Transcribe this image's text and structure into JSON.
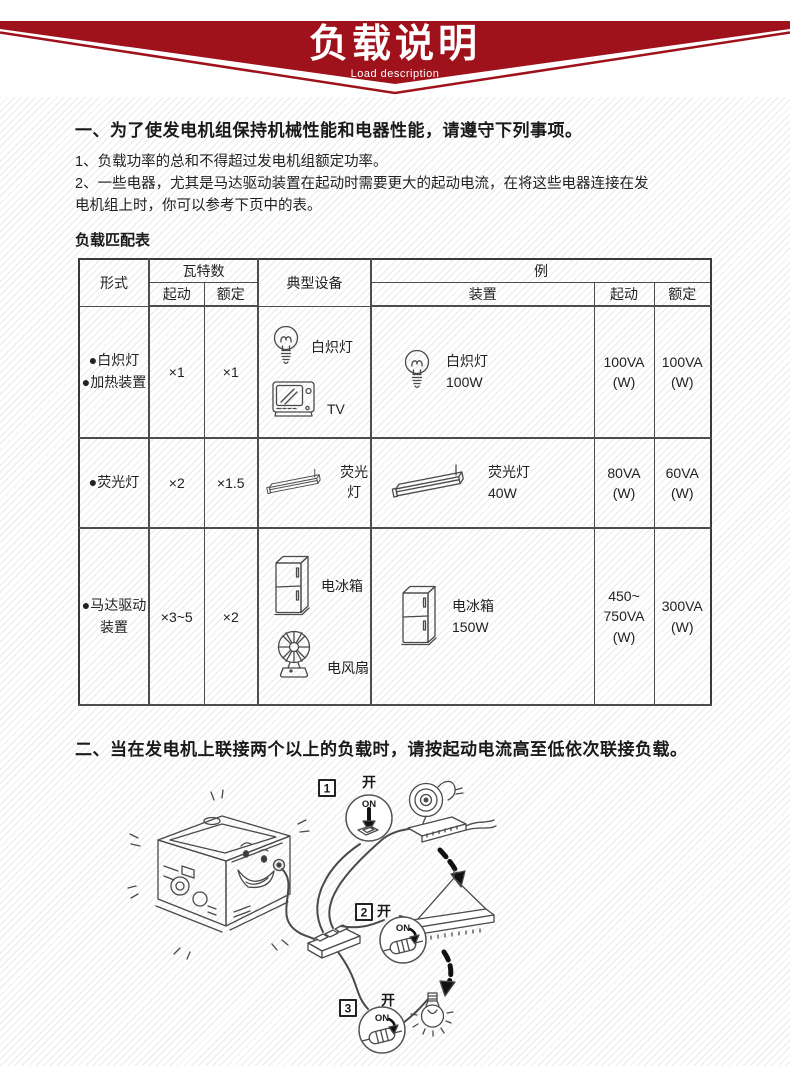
{
  "banner": {
    "title": "负载说明",
    "subtitle": "Load description"
  },
  "colors": {
    "banner_red": "#9f121b"
  },
  "section1": {
    "heading": "一、为了使发电机组保持机械性能和电器性能，请遵守下列事项。",
    "item1": "1、负载功率的总和不得超过发电机组额定功率。",
    "item2": "2、一些电器，尤其是马达驱动装置在起动时需要更大的起动电流，在将这些电器连接在发\n电机组上时，你可以参考下页中的表。"
  },
  "table": {
    "caption": "负载匹配表",
    "header": {
      "type": "形式",
      "watts": "瓦特数",
      "start": "起动",
      "rated": "额定",
      "typical": "典型设备",
      "example": "例",
      "device": "装置",
      "ex_start": "起动",
      "ex_rated": "额定"
    },
    "rows": [
      {
        "type": "●白炽灯\n●加热装置",
        "start_factor": "×1",
        "rated_factor": "×1",
        "typical1_label": "白炽灯",
        "typical2_label": "TV",
        "device_label": "白炽灯\n100W",
        "ex_start": "100VA\n(W)",
        "ex_rated": "100VA\n(W)"
      },
      {
        "type": "●荧光灯",
        "start_factor": "×2",
        "rated_factor": "×1.5",
        "typical1_label": "荧光灯",
        "device_label": "荧光灯\n40W",
        "ex_start": "80VA\n(W)",
        "ex_rated": "60VA\n(W)"
      },
      {
        "type": "●马达驱动\n装置",
        "start_factor": "×3~5",
        "rated_factor": "×2",
        "typical1_label": "电冰箱",
        "typical2_label": "电风扇",
        "device_label": "电冰箱\n150W",
        "ex_start": "450~\n750VA\n(W)",
        "ex_rated": "300VA\n(W)"
      }
    ]
  },
  "section2": {
    "heading": "二、当在发电机上联接两个以上的负载时，请按起动电流高至低依次联接负载。"
  },
  "illustration": {
    "steps": [
      {
        "num": "1",
        "power": "开",
        "switch": "ON"
      },
      {
        "num": "2",
        "power": "开",
        "switch": "ON"
      },
      {
        "num": "3",
        "power": "开",
        "switch": "ON"
      }
    ]
  }
}
